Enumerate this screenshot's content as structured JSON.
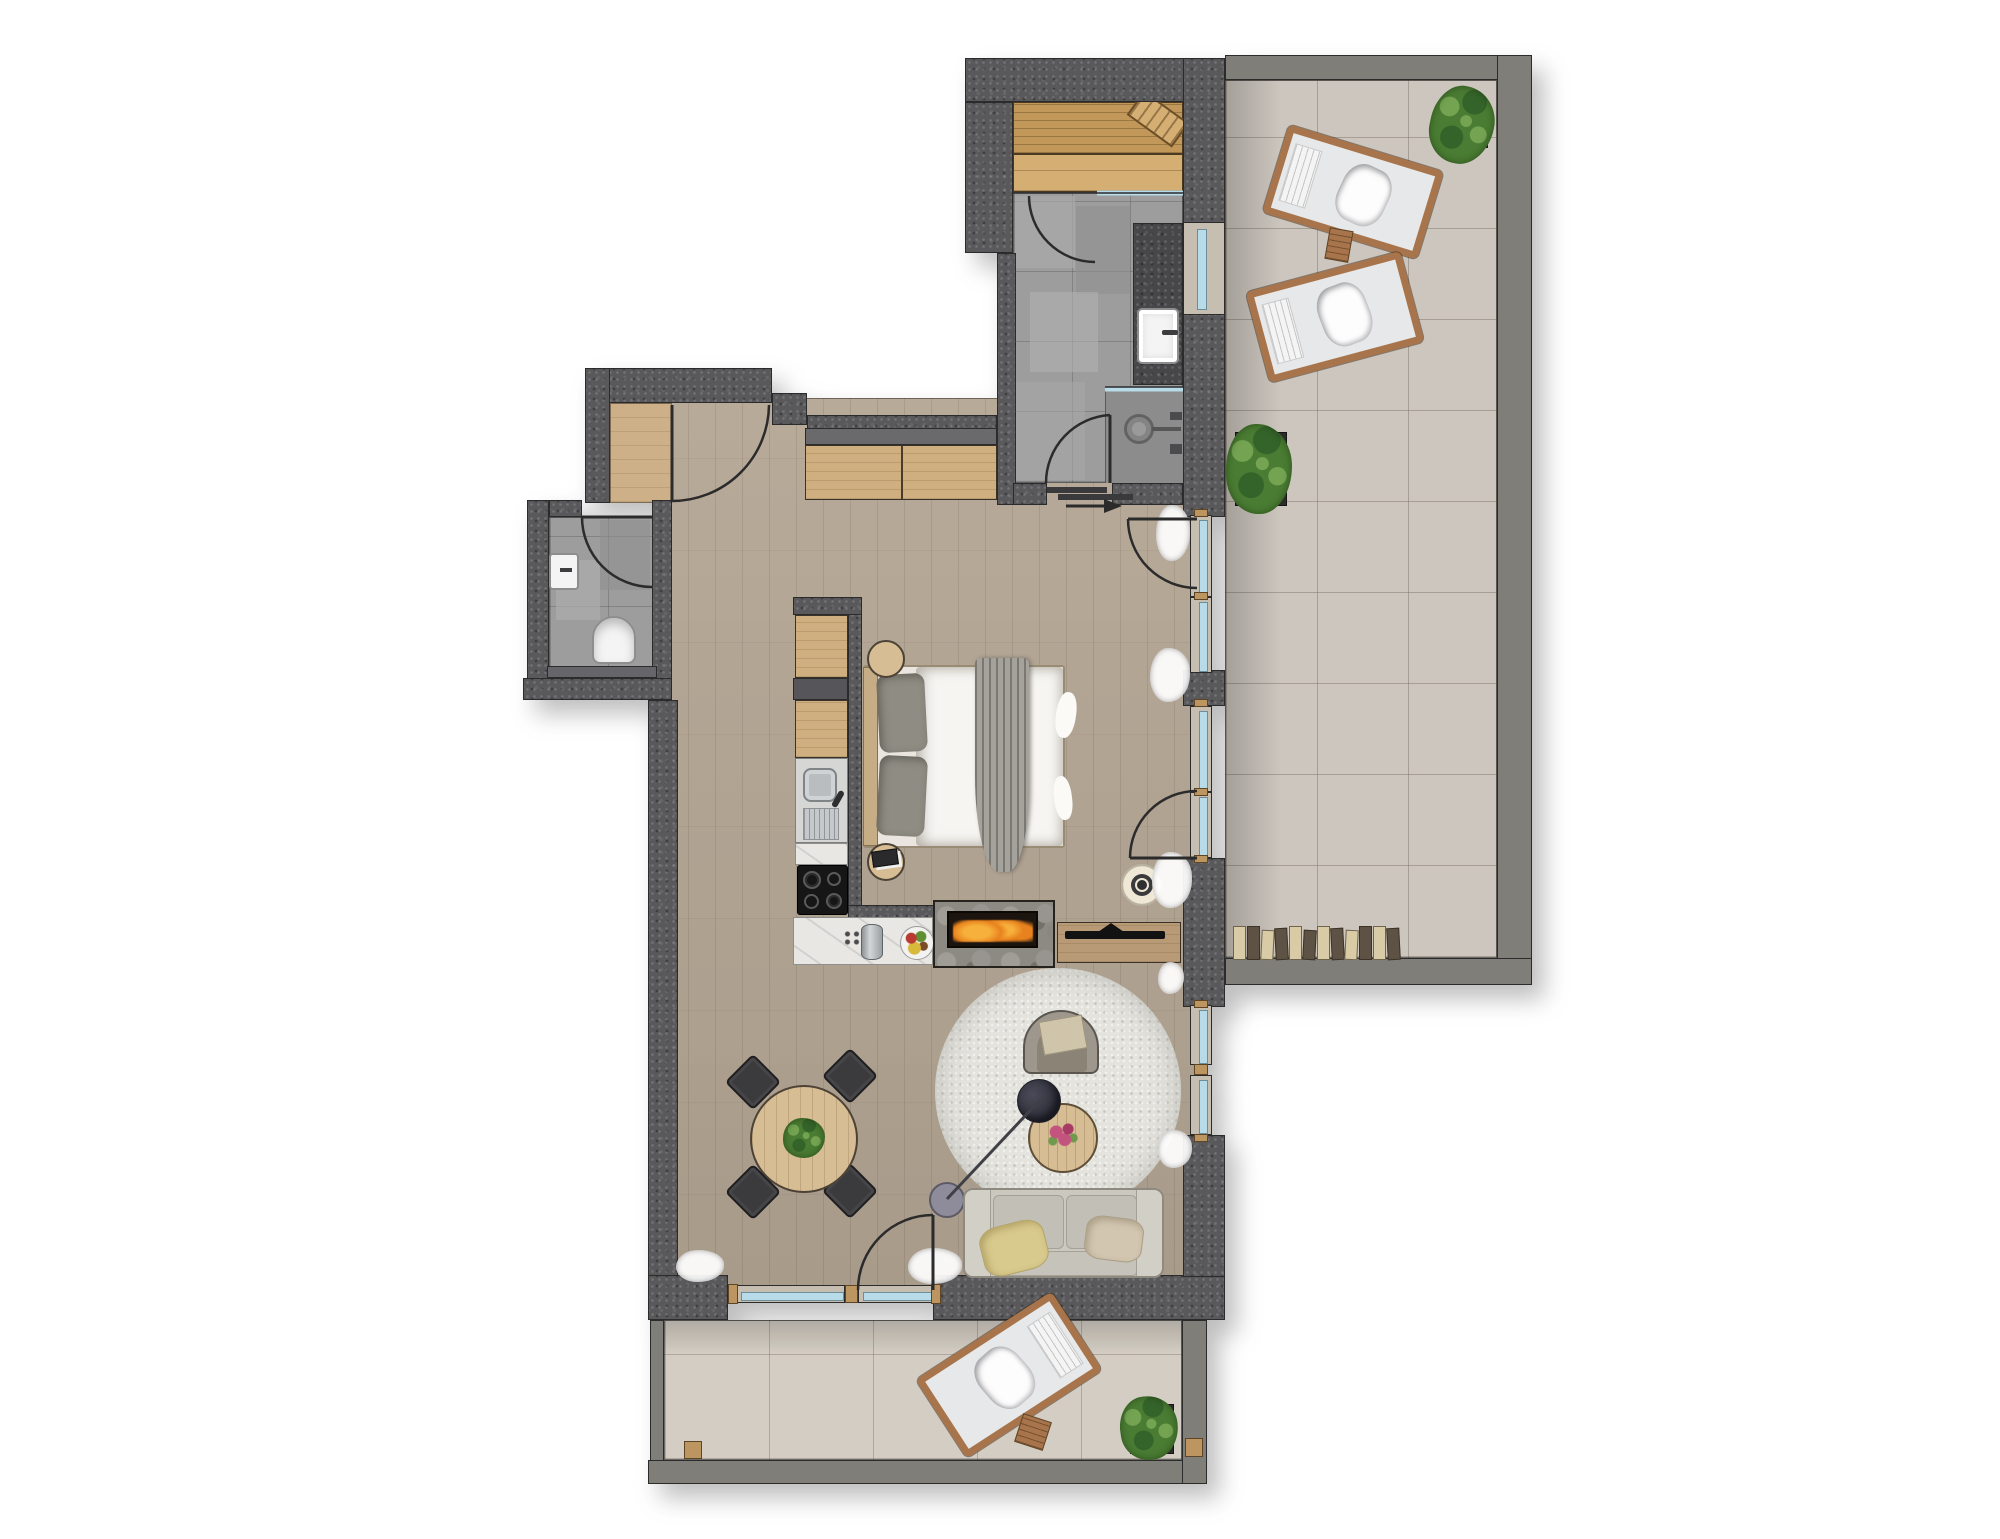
{
  "canvas": {
    "width": 2000,
    "height": 1539
  },
  "palette": {
    "line": "#2b2b2c",
    "wallDark": "#59595c",
    "wallGray": "#7f7e78",
    "grayBand": "#6a6a6c",
    "floorWood": "#b4a593",
    "floorEntry": "#cdb088",
    "tileBath": "#9d9d9d",
    "tileShower": "#8c8c8c",
    "tileTerrace": "#ccc6be",
    "tileTerraceB": "#d3cdc3",
    "saunaWood": "#c2975a",
    "saunaBench": "#d4ae72",
    "cabinetWood": "#cfae7f",
    "tableWood": "#d7bd93",
    "frameWood": "#a8744b",
    "thresholdTan": "#bd9560",
    "marble": "#e9e7e3",
    "steel": "#b9bdc0",
    "cooktop": "#161616",
    "glass": "#b7dbe8",
    "windowFrame": "#c6beb0",
    "rug": "#e4e3de",
    "sofa": "#cbc8c0",
    "sofaCushion": "#c2bfb7",
    "pillowYellow": "#d8c98c",
    "pillowBeige": "#d2c6b0",
    "armchair": "#9b948a",
    "armchairCushion": "#cfc4a9",
    "lampHead": "#30303b",
    "lampBase": "#8e8b9a",
    "chairDark": "#3b3b3d",
    "bedWhite": "#f6f5f2",
    "blanketGray": "#a5a29b",
    "pillowGray": "#8f8c83",
    "headboard": "#c7ad85",
    "stone": "#8d8a84",
    "firebox": "#1c140f",
    "flame": "#e8821e",
    "flameLight": "#f7b03c",
    "tv": "#121212",
    "plantGreen": "#4a7c33",
    "plantDark": "#35642a",
    "plantLight": "#74a452",
    "planter": "#2c2c2a",
    "logCream": "#d9cba6",
    "logDark": "#5d5244",
    "vanity": "#474749",
    "porcelain": "#f4f4f4",
    "shelfGray": "#66666a",
    "curtain": "#ffffff",
    "flowerPink": "#c2547e",
    "shadow": "rgba(70,70,70,0.35)"
  },
  "inventory": {
    "type": "apartment-floor-plan",
    "rooms": [
      {
        "name": "entry-nook",
        "features": [
          "entry-door",
          "wood-floor"
        ]
      },
      {
        "name": "wc",
        "features": [
          "toilet",
          "hand-basin",
          "shelf",
          "swing-door"
        ]
      },
      {
        "name": "bathroom",
        "features": [
          "vanity-counter",
          "basin",
          "walk-in-shower",
          "window",
          "swing-door",
          "sliding-threshold"
        ]
      },
      {
        "name": "sauna",
        "features": [
          "plank-benches",
          "headrest",
          "glass-front",
          "swing-door"
        ]
      },
      {
        "name": "living-kitchen-sleeping",
        "features": [
          "kitchenette",
          "sink",
          "cooktop",
          "double-bed",
          "bedside-table",
          "bedside-table",
          "sideboard",
          "fireplace",
          "tv-bench",
          "dining-table",
          "dining-chair",
          "dining-chair",
          "dining-chair",
          "dining-chair",
          "sofa",
          "armchair",
          "coffee-table",
          "floor-lamp",
          "round-rug",
          "ceiling-lamp",
          "curtains",
          "glazed-terrace-doors",
          "entrance-arrow"
        ]
      },
      {
        "name": "terrace-east",
        "features": [
          "sun-lounger",
          "sun-lounger",
          "side-table",
          "potted-plant",
          "potted-plant",
          "firewood-stack"
        ]
      },
      {
        "name": "terrace-south",
        "features": [
          "sun-lounger",
          "side-table",
          "potted-plant",
          "corner-posts"
        ]
      }
    ]
  }
}
